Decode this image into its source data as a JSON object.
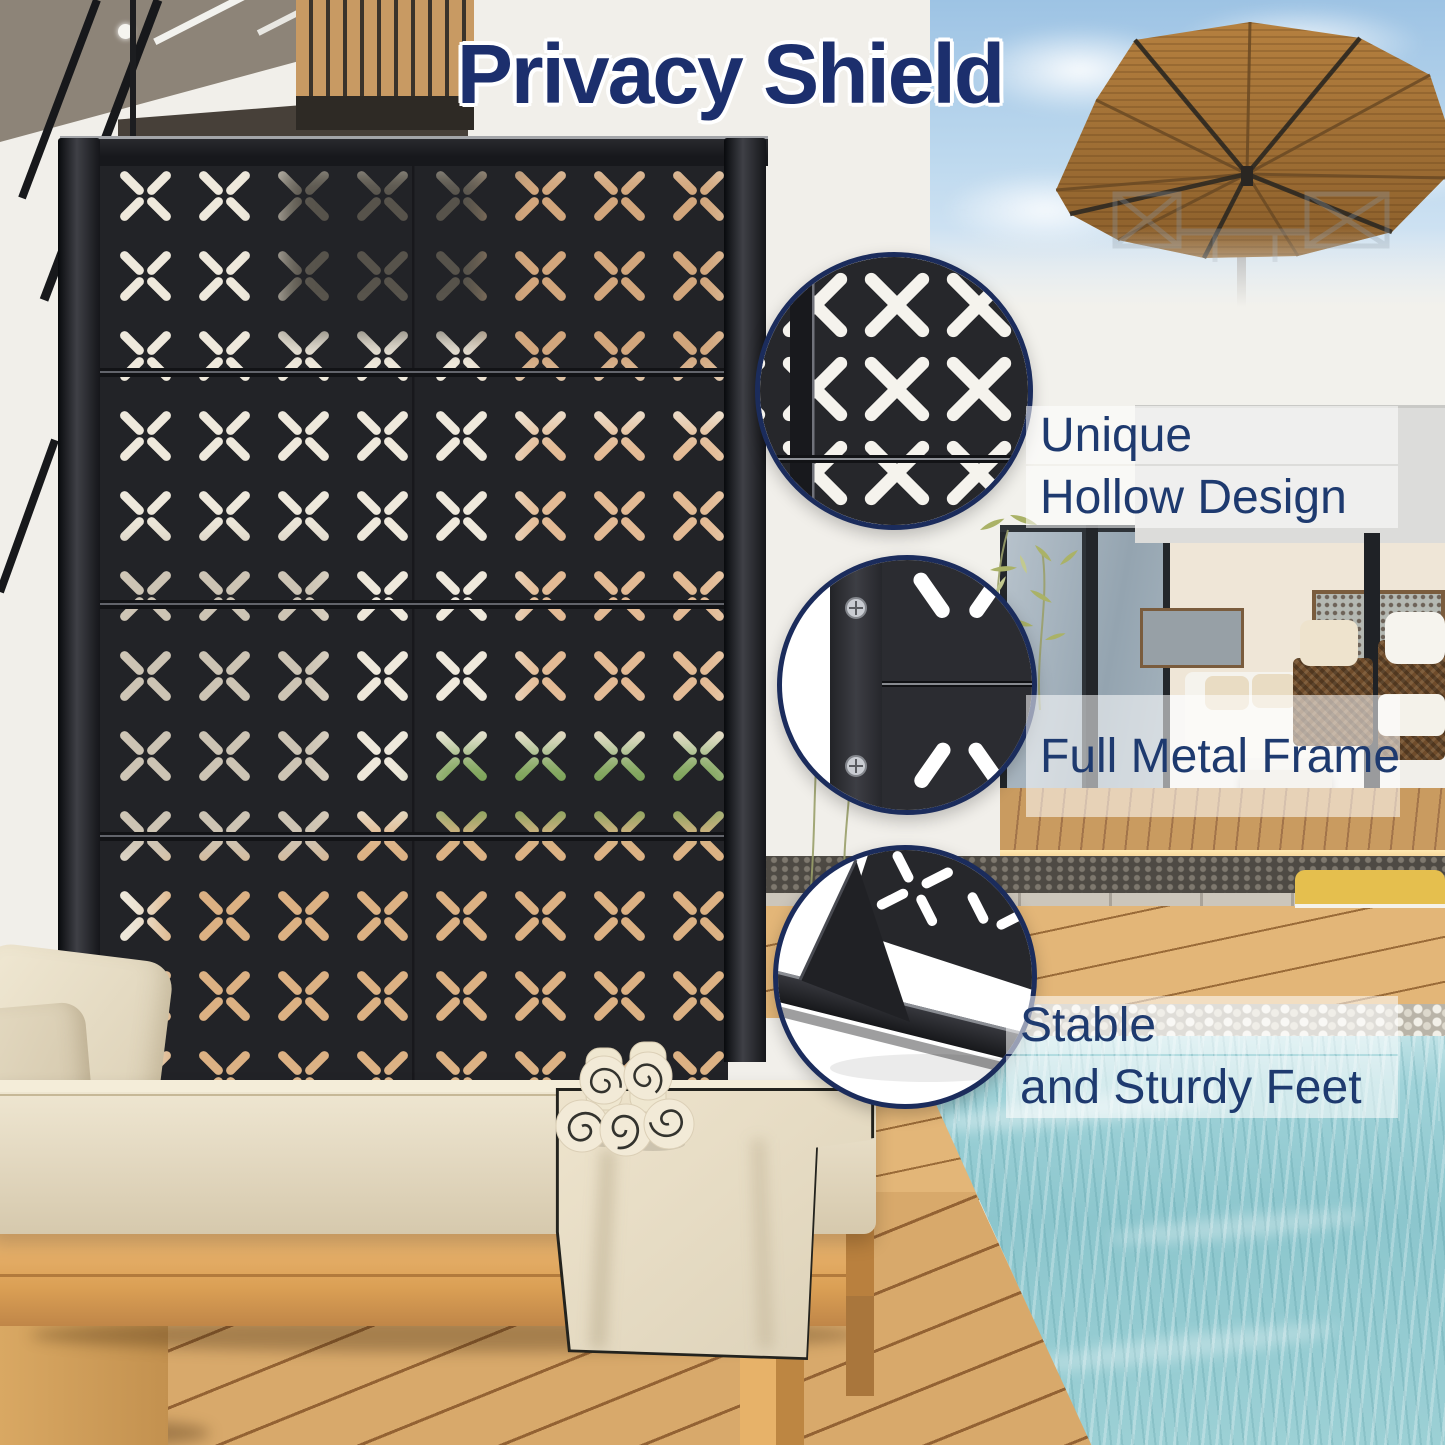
{
  "title": "Privacy Shield",
  "callouts": [
    {
      "id": "hollow-design",
      "lines": [
        "Unique",
        "Hollow Design"
      ]
    },
    {
      "id": "metal-frame",
      "lines": [
        "Full Metal Frame"
      ]
    },
    {
      "id": "sturdy-feet",
      "lines": [
        "Stable",
        "and Sturdy Feet"
      ]
    }
  ],
  "colors": {
    "title_navy": "#1c2f6d",
    "label_navy": "#1e3a6f",
    "callout_ring": "#1b2c5c",
    "screen_black": "#222327",
    "pool_teal": "#95cad1",
    "umbrella_brown": "#b5803f",
    "deck_wood": "#d5a467",
    "cushion_cream": "#e8dfc9"
  }
}
